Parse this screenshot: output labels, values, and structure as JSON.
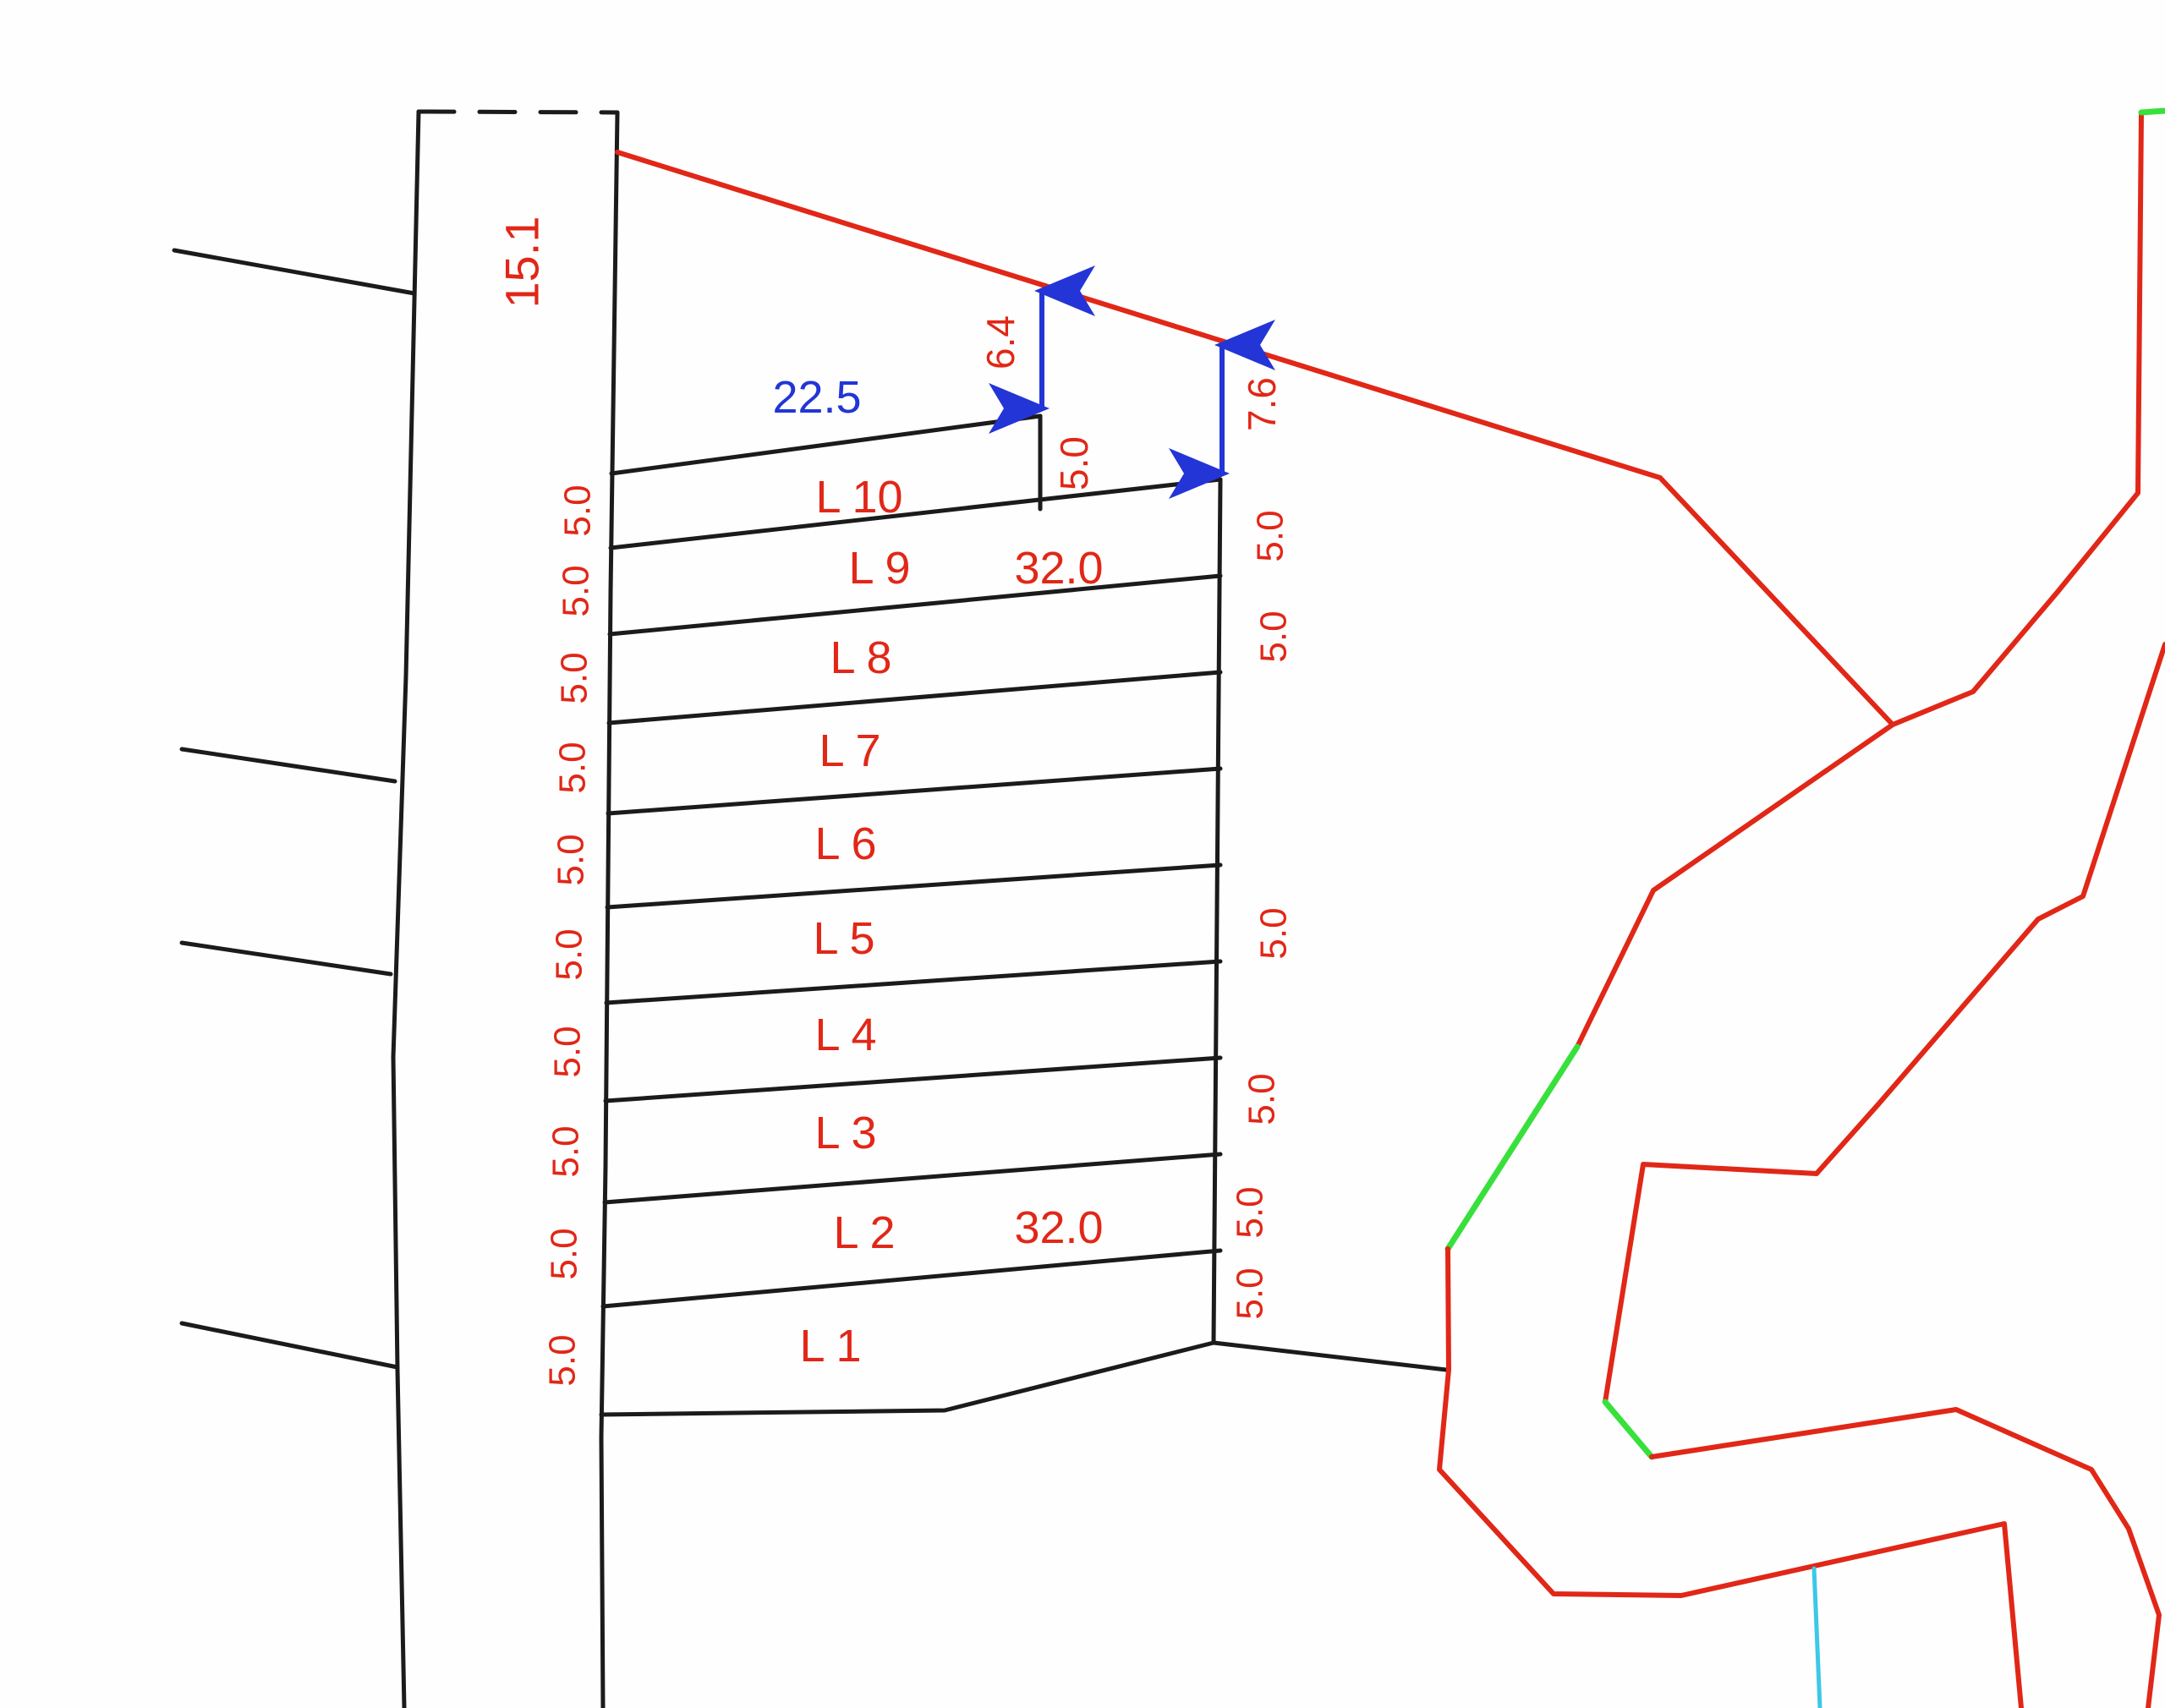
{
  "drawing": {
    "type": "cadastral-subdivision-plan",
    "colors": {
      "paper": "#fefefe",
      "black": "#1b1b1b",
      "red": "#e12717",
      "green": "#38e03c",
      "cyan": "#3cc8e8",
      "blue": "#2335d6"
    },
    "road": {
      "frontage_dim": "15.1"
    },
    "lots": [
      {
        "label": "L 10"
      },
      {
        "label": "L 9"
      },
      {
        "label": "L 8"
      },
      {
        "label": "L 7"
      },
      {
        "label": "L 6"
      },
      {
        "label": "L 5"
      },
      {
        "label": "L 4"
      },
      {
        "label": "L 3"
      },
      {
        "label": "L 2"
      },
      {
        "label": "L 1"
      }
    ],
    "dims": {
      "l10_width_top": "22.5",
      "depth_upper": "32.0",
      "depth_lower": "32.0",
      "gap_to_boundary_l10": "6.4",
      "gap_to_boundary_l9": "7.6",
      "l10_right_side": "5.0",
      "left_side_widths": [
        "5.0",
        "5.0",
        "5.0",
        "5.0",
        "5.0",
        "5.0",
        "5.0",
        "5.0",
        "5.0",
        "5.0"
      ],
      "right_side_widths": [
        "5.0",
        "5.0",
        "5.0",
        "5.0",
        "5.0",
        "5.0"
      ]
    }
  }
}
